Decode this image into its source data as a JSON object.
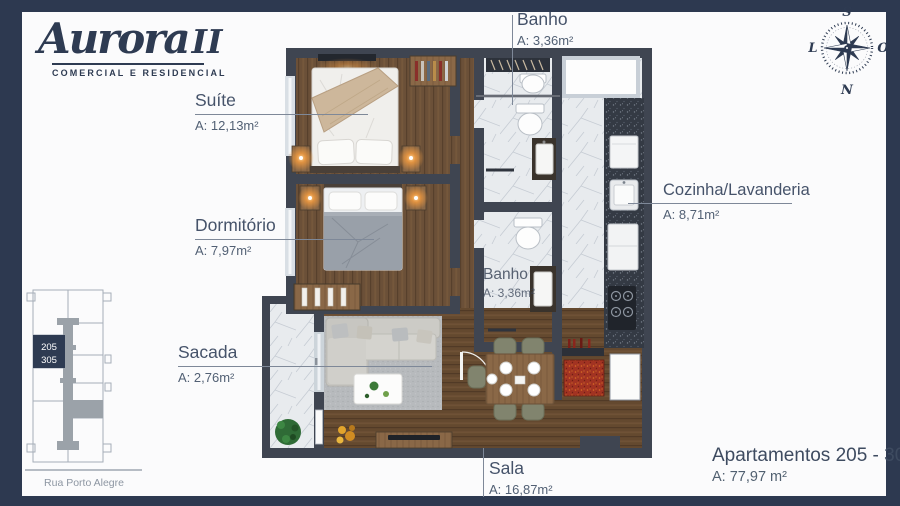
{
  "logo": {
    "name": "Aurora",
    "suffix": "II",
    "tagline": "COMERCIAL E RESIDENCIAL"
  },
  "compass": {
    "top": "S",
    "right": "O",
    "bottom": "N",
    "left": "L"
  },
  "rooms": {
    "banho_top": {
      "label": "Banho",
      "area": "A: 3,36m²"
    },
    "suite": {
      "label": "Suíte",
      "area": "A: 12,13m²"
    },
    "dormitorio": {
      "label": "Dormitório",
      "area": "A: 7,97m²"
    },
    "cozinha": {
      "label": "Cozinha/Lavanderia",
      "area": "A: 8,71m²"
    },
    "banho_inner": {
      "label": "Banho",
      "area": "A: 3,36m²"
    },
    "sacada": {
      "label": "Sacada",
      "area": "A: 2,76m²"
    },
    "sala": {
      "label": "Sala",
      "area": "A: 16,87m²"
    }
  },
  "keyplan": {
    "unit_line1": "205",
    "unit_line2": "305",
    "street": "Rua Porto Alegre"
  },
  "footer": {
    "title": "Apartamentos 205 - 305",
    "area": "A: 77,97 m²"
  },
  "colors": {
    "frame_navy": "#2d3950",
    "label_text": "#46536a",
    "wall": "#3f4551",
    "wood_floor": "#6b5038",
    "marble": "#e8ebee",
    "granite": "#343a44",
    "accent_orange": "#f09a40",
    "accent_red": "#a23322",
    "plant_green": "#2f6b36",
    "keyplan_navy": "#2e3b52"
  }
}
